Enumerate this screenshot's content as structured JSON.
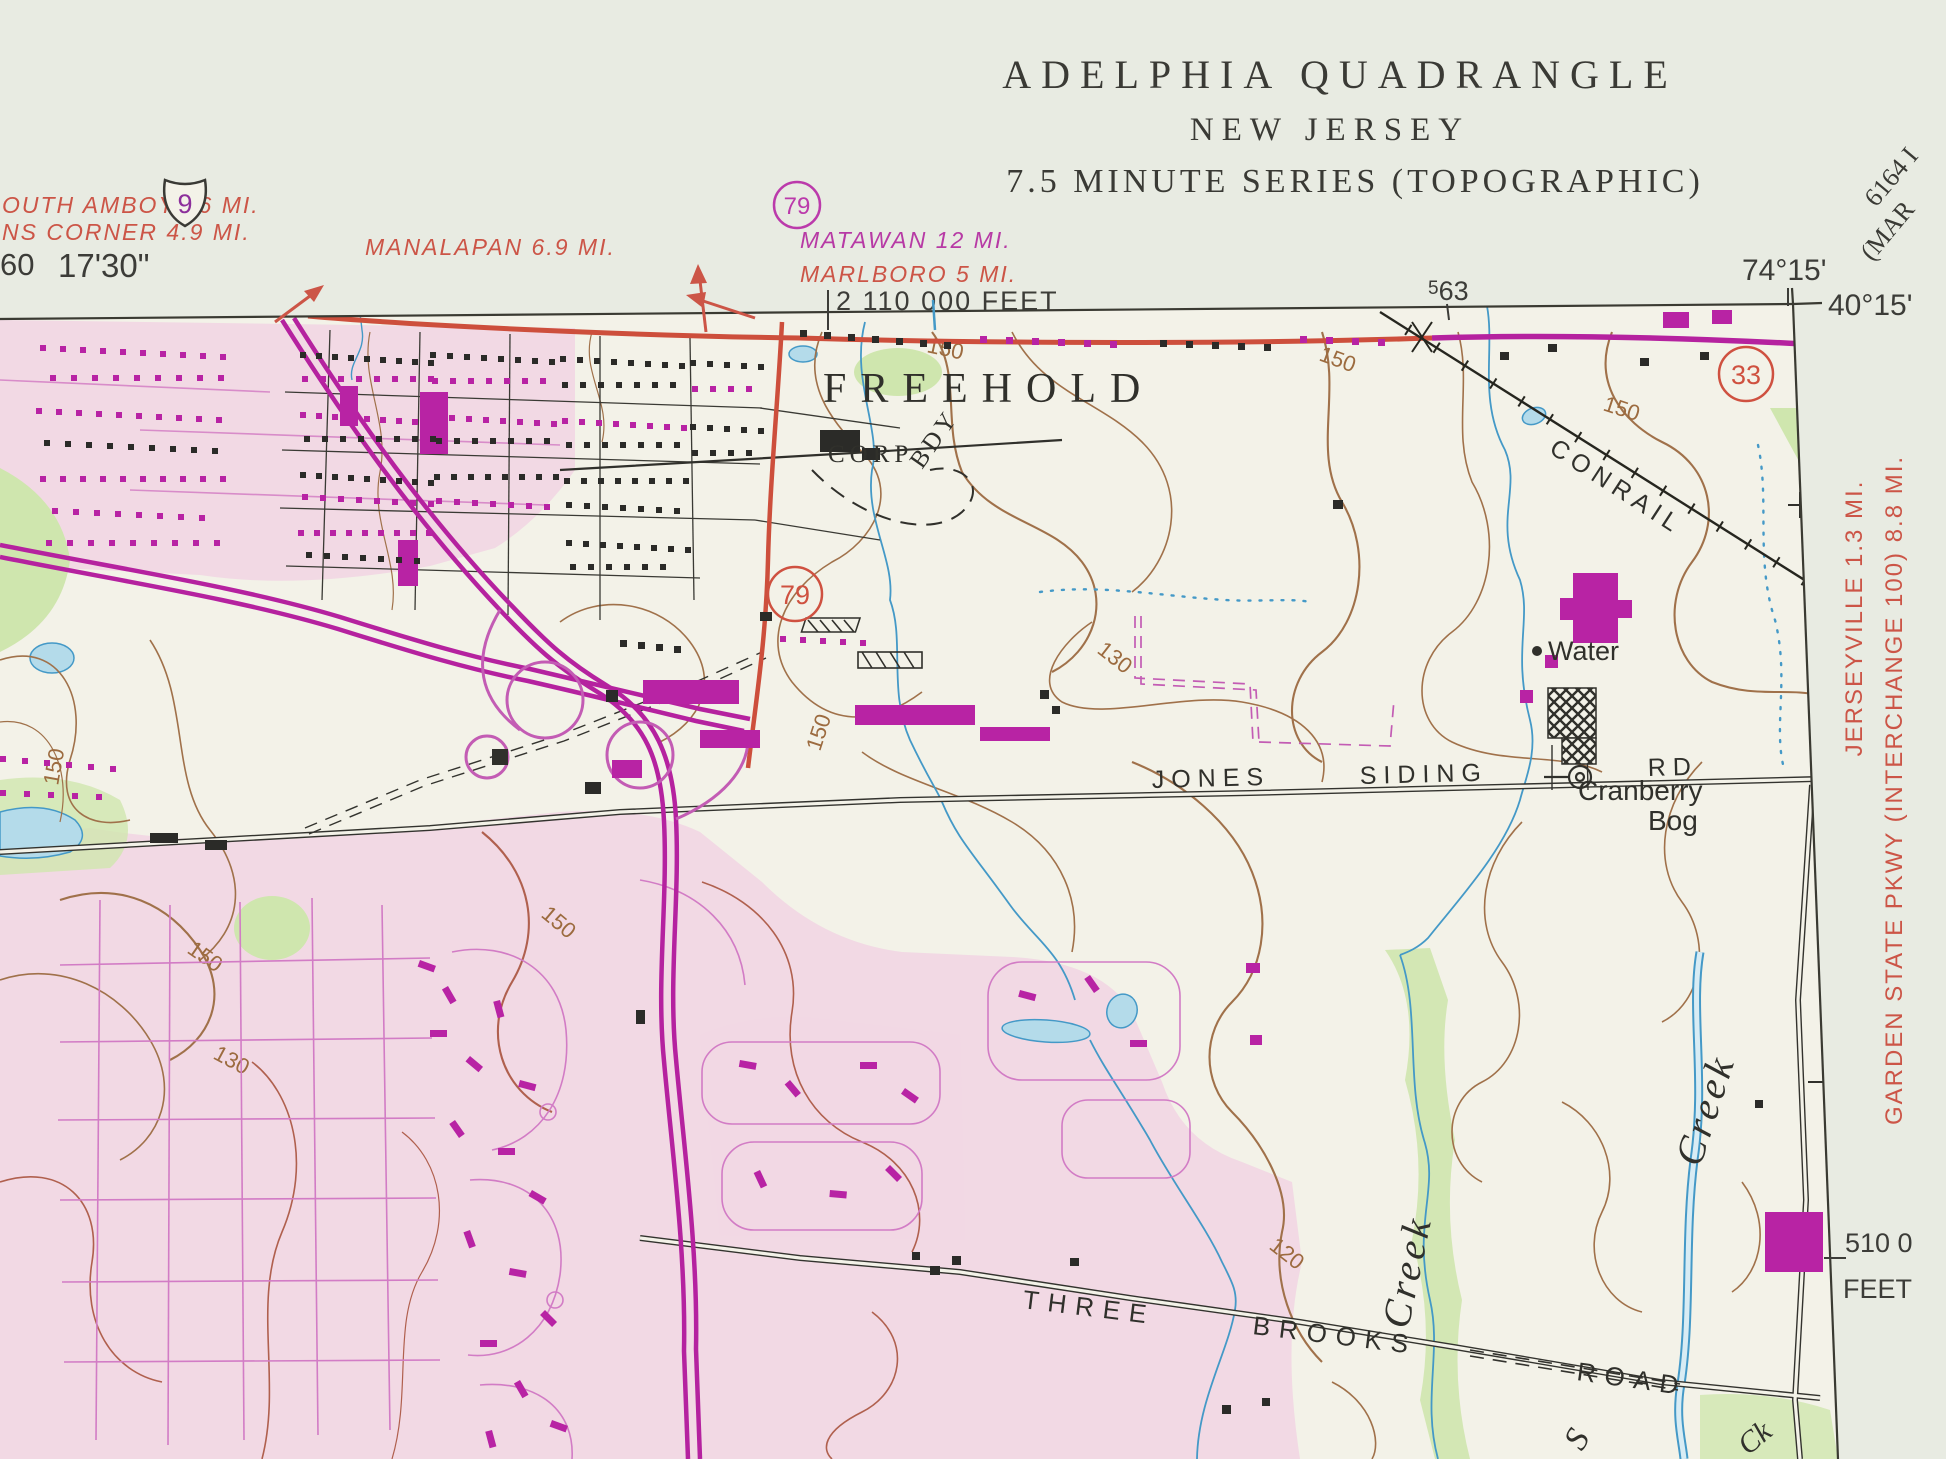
{
  "map": {
    "title": {
      "line1": "ADELPHIA QUADRANGLE",
      "line2": "NEW JERSEY",
      "line3": "7.5 MINUTE SERIES (TOPOGRAPHIC)"
    },
    "corner_notes": {
      "series_code": "6164 I",
      "adjoining_partial": "(MAR"
    },
    "margin": {
      "lon_right": "74°15'",
      "lat_right": "40°15'",
      "grid563_sup": "5",
      "grid563_main": "63",
      "grid_feet_top": "2 110 000 FEET",
      "left_partial": "60",
      "lon_left": "17'30\"",
      "grid_feet_right_value": "510 0",
      "grid_feet_right_unit": "FEET",
      "dest_top_left_1": "OUTH AMBOY 16 MI.",
      "dest_top_left_2": "NS CORNER 4.9 MI.",
      "dest_manalapan": "MANALAPAN 6.9 MI.",
      "dest_matawan": "MATAWAN 12 MI.",
      "dest_marlboro": "MARLBORO 5 MI.",
      "dest_right_1": "JERSEYVILLE 1.3 MI.",
      "dest_right_2": "GARDEN STATE PKWY (INTERCHANGE 100) 8.8 MI."
    },
    "shields": {
      "us9": "9",
      "nj79_top": "79",
      "nj79_mid": "79",
      "nj33": "33"
    },
    "labels": {
      "city": "FREEHOLD",
      "corp": "CORP",
      "bdy": "BDY",
      "railroad": "CONRAIL",
      "water": "Water",
      "cranberry_line1": "Cranberry",
      "cranberry_line2": "Bog",
      "road_jones": "JONES",
      "road_siding": "SIDING",
      "road_rd": "RD",
      "road_three": "THREE",
      "road_brooks": "BROOKS",
      "road_road": "ROAD",
      "creek_a": "Creek",
      "creek_b": "Creek",
      "creek_partial_s": "S",
      "creek_partial_ck": "Ck"
    },
    "contours": {
      "c150": "150",
      "c130": "130",
      "c120": "120"
    },
    "colors": {
      "paper_margin": "#e8ebe2",
      "map_ground": "#f3f2e8",
      "urban_pink": "#f1d7e4",
      "revision_magenta": "#b5229f",
      "road_red": "#cd4f3c",
      "text_red": "#cc5547",
      "contour_brown": "#a0714a",
      "water_blue": "#4499c7",
      "pond_fill": "#b4dbea",
      "woodland_green": "#cfe6ae",
      "ink_black": "#30302b"
    }
  }
}
